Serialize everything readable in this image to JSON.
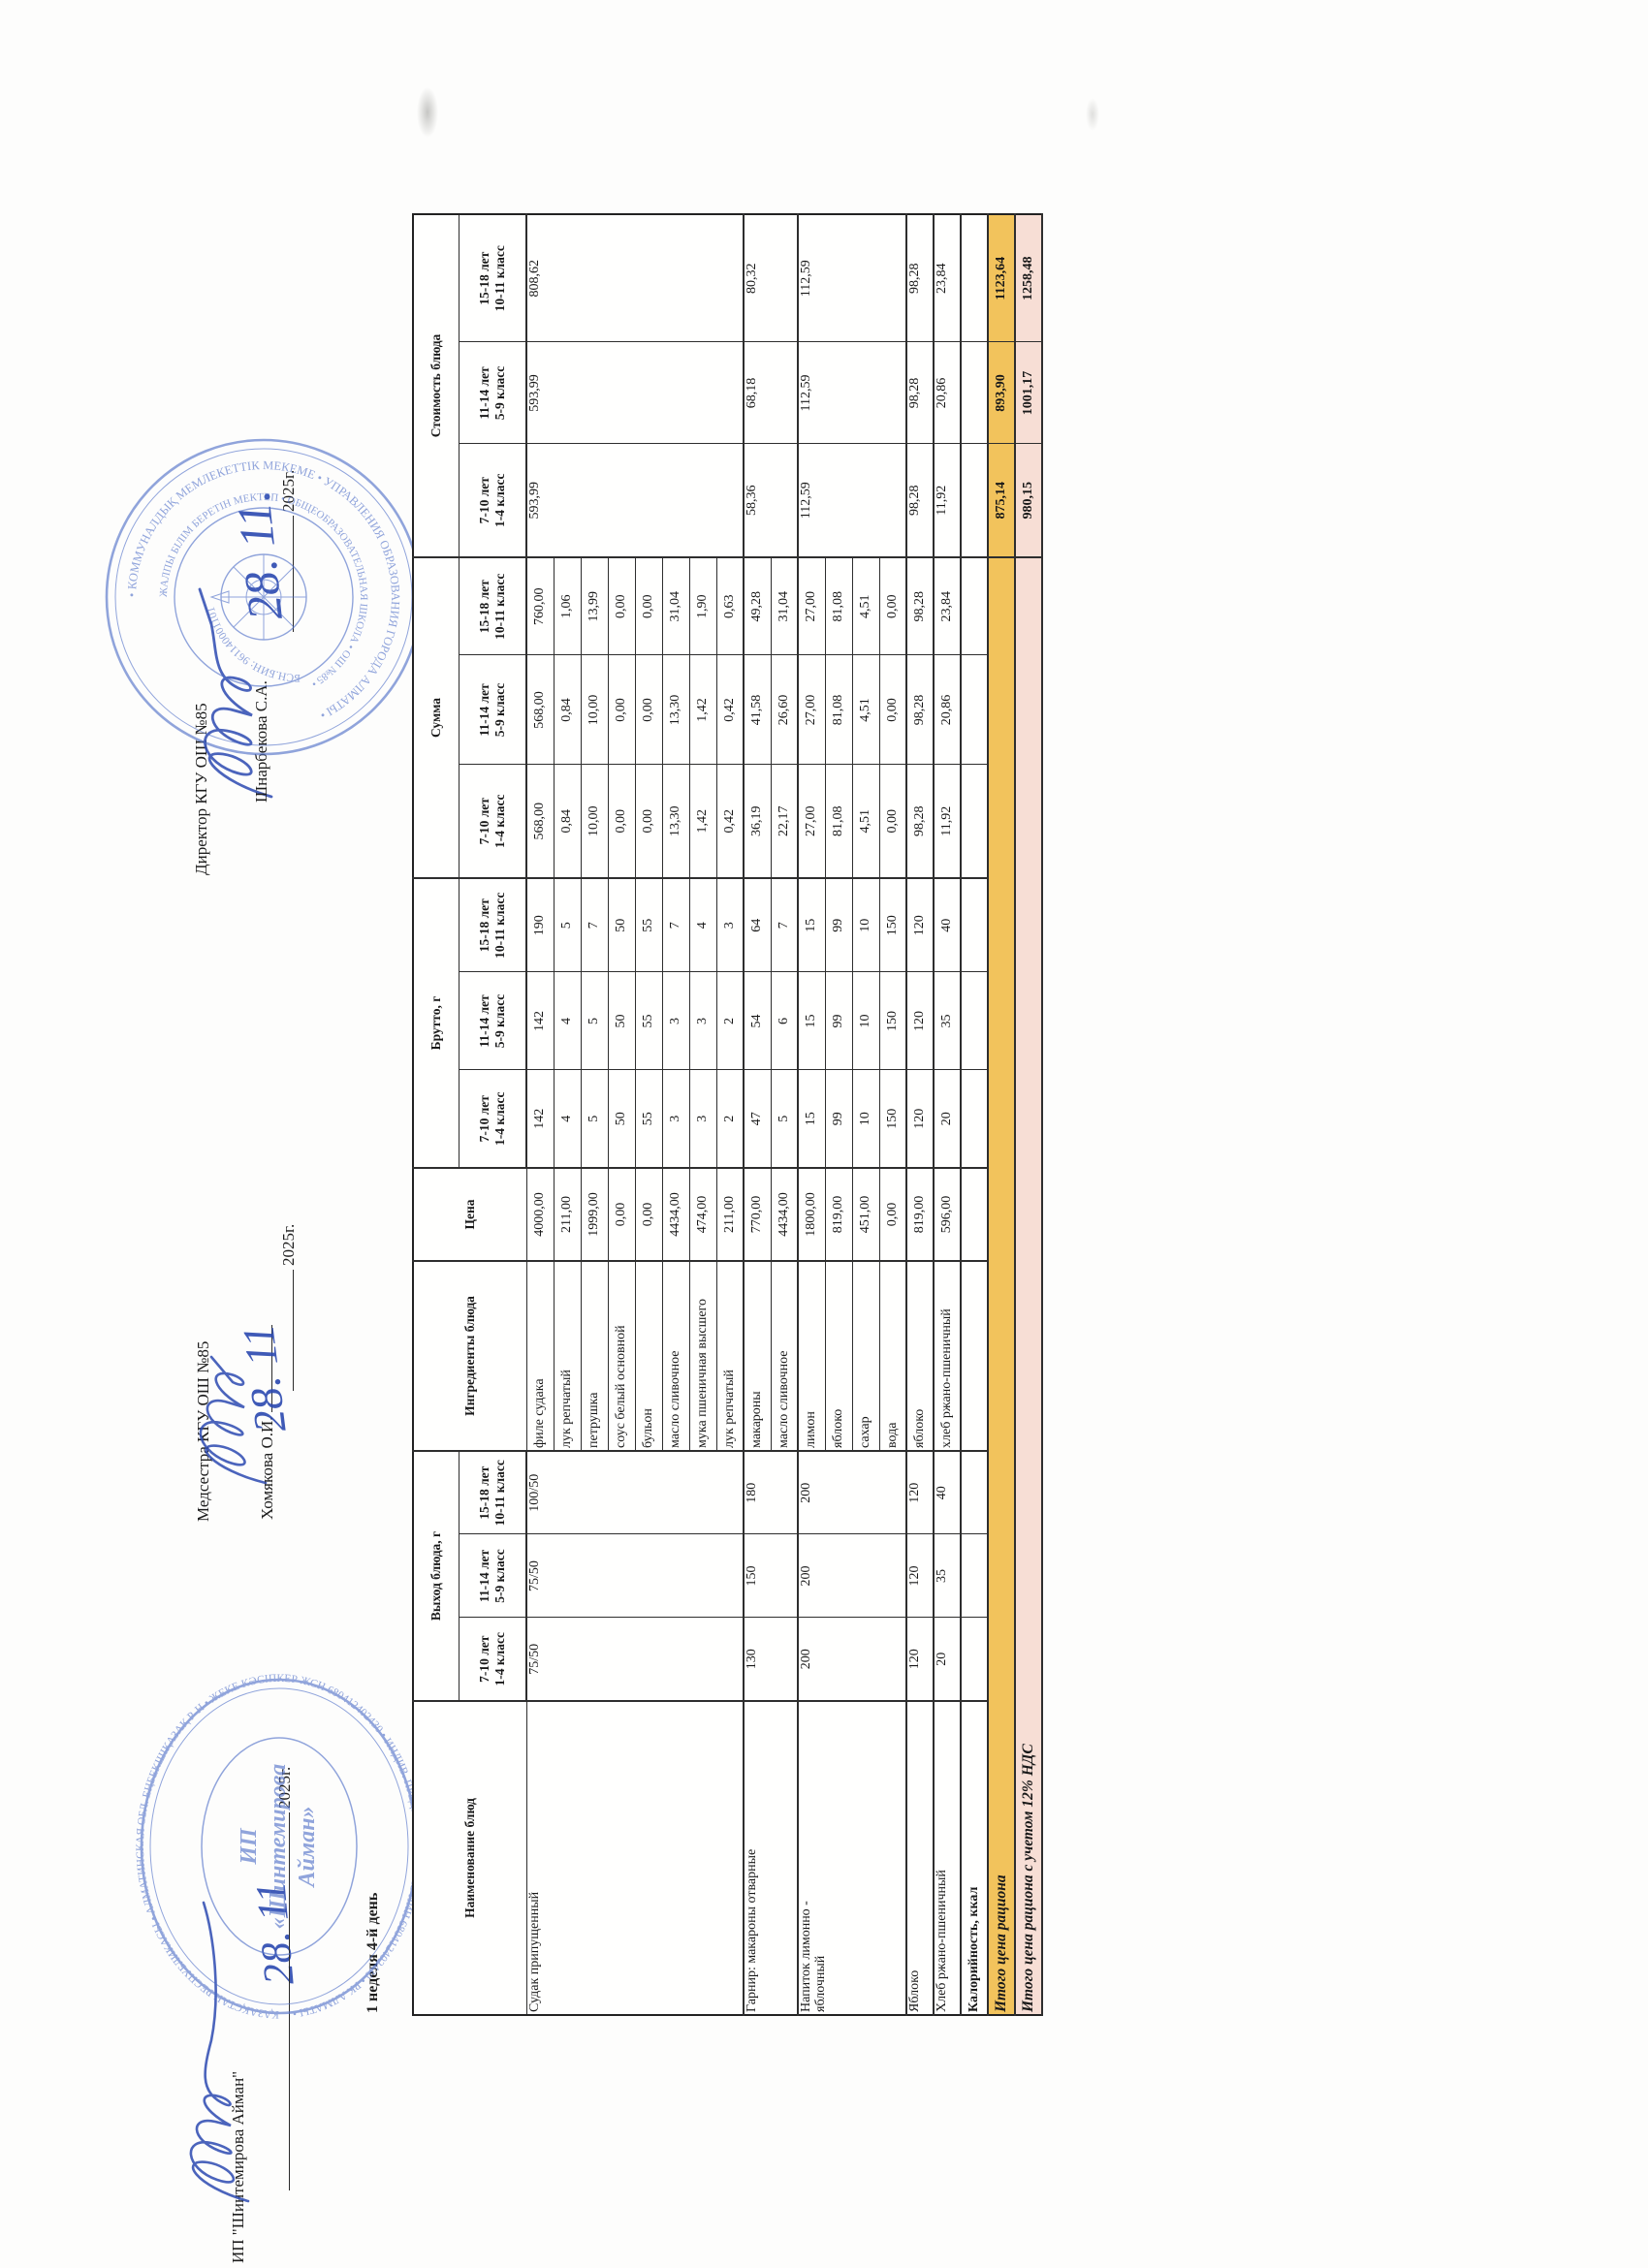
{
  "doc": {
    "left": {
      "org": "ИП \"Шинтемирова Айман\"",
      "year_line": "2025г.",
      "week_label": "1 неделя 4-й день",
      "handwritten_date": "28. 11"
    },
    "middle": {
      "role": "Медсестра КГУ ОШ №85",
      "name": "Хомякова О.И.",
      "year_line": "2025г.",
      "handwritten_date": "28. 11"
    },
    "right": {
      "role": "Директор КГУ ОШ №85",
      "name": "Шнарбекова С.А.",
      "year_line": "2025г.",
      "handwritten_date": "28. 11."
    }
  },
  "stamps": {
    "school": {
      "ring_text": "• КОММУНАЛДЫҚ МЕМЛЕКЕТТІК МЕКЕМЕ • УПРАВЛЕНИЯ ОБРАЗОВАНИЯ ГОРОДА АЛМАТЫ •",
      "ring_text2": "ЖАЛПЫ БІЛІМ БЕРЕТІН МЕКТЕП • ОБЩЕОБРАЗОВАТЕЛЬНАЯ ШКОЛА • ОШ №85 •",
      "bin_text": "БСН.БИН: 961140001101"
    },
    "ip": {
      "ring_text": "ҚАЗАҚСТАН РЕСПУБЛИКАСЫ • АЛМАТИНСКАЯ ОБЛ. ЕҢБЕКШІҚАЗАҚ Р-Н • ЖЕКЕ КӘСІПКЕР ЖСН 680412402430 • ИНДИВ. ПРЕДПРИНИМАТЕЛЬ ИИН 680412402430 • РК АЛМАТЫ •",
      "center_line1": "ИП",
      "center_line2": "«Шинтемирова",
      "center_line3": "Айман»"
    }
  },
  "table": {
    "headers": {
      "name": "Наименование блюд",
      "vyhod": "Выход блюда, г",
      "ingredients": "Ингредиенты блюда",
      "price": "Цена",
      "brutto": "Брутто, г",
      "summa": "Сумма",
      "cost": "Стоимость блюда"
    },
    "age_groups": [
      {
        "age": "7-10 лет",
        "grade": "1-4 класс"
      },
      {
        "age": "11-14 лет",
        "grade": "5-9 класс"
      },
      {
        "age": "15-18 лет",
        "grade": "10-11 класс"
      }
    ],
    "dishes": [
      {
        "name": "Судак припущенный",
        "vyhod": [
          "75/50",
          "75/50",
          "100/50"
        ],
        "cost": [
          "593,99",
          "593,99",
          "808,62"
        ],
        "ingredients": [
          {
            "name": "филе судака",
            "price": "4000,00",
            "brutto": [
              "142",
              "142",
              "190"
            ],
            "summa": [
              "568,00",
              "568,00",
              "760,00"
            ]
          },
          {
            "name": "лук репчатый",
            "price": "211,00",
            "brutto": [
              "4",
              "4",
              "5"
            ],
            "summa": [
              "0,84",
              "0,84",
              "1,06"
            ]
          },
          {
            "name": "петрушка",
            "price": "1999,00",
            "brutto": [
              "5",
              "5",
              "7"
            ],
            "summa": [
              "10,00",
              "10,00",
              "13,99"
            ]
          },
          {
            "name": "соус белый основной",
            "price": "0,00",
            "brutto": [
              "50",
              "50",
              "50"
            ],
            "summa": [
              "0,00",
              "0,00",
              "0,00"
            ]
          },
          {
            "name": "бульон",
            "price": "0,00",
            "brutto": [
              "55",
              "55",
              "55"
            ],
            "summa": [
              "0,00",
              "0,00",
              "0,00"
            ]
          },
          {
            "name": "масло сливочное",
            "price": "4434,00",
            "brutto": [
              "3",
              "3",
              "7"
            ],
            "summa": [
              "13,30",
              "13,30",
              "31,04"
            ]
          },
          {
            "name": "мука пшеничная высшего",
            "price": "474,00",
            "brutto": [
              "3",
              "3",
              "4"
            ],
            "summa": [
              "1,42",
              "1,42",
              "1,90"
            ]
          },
          {
            "name": "лук репчатый",
            "price": "211,00",
            "brutto": [
              "2",
              "2",
              "3"
            ],
            "summa": [
              "0,42",
              "0,42",
              "0,63"
            ]
          }
        ]
      },
      {
        "name": "Гарнир: макароны отварные",
        "vyhod": [
          "130",
          "150",
          "180"
        ],
        "cost": [
          "58,36",
          "68,18",
          "80,32"
        ],
        "ingredients": [
          {
            "name": "макароны",
            "price": "770,00",
            "brutto": [
              "47",
              "54",
              "64"
            ],
            "summa": [
              "36,19",
              "41,58",
              "49,28"
            ]
          },
          {
            "name": "масло сливочное",
            "price": "4434,00",
            "brutto": [
              "5",
              "6",
              "7"
            ],
            "summa": [
              "22,17",
              "26,60",
              "31,04"
            ]
          }
        ]
      },
      {
        "name": "Напиток лимонно -",
        "name2": "яблочный",
        "vyhod": [
          "200",
          "200",
          "200"
        ],
        "cost": [
          "112,59",
          "112,59",
          "112,59"
        ],
        "ingredients": [
          {
            "name": "лимон",
            "price": "1800,00",
            "brutto": [
              "15",
              "15",
              "15"
            ],
            "summa": [
              "27,00",
              "27,00",
              "27,00"
            ]
          },
          {
            "name": "яблоко",
            "price": "819,00",
            "brutto": [
              "99",
              "99",
              "99"
            ],
            "summa": [
              "81,08",
              "81,08",
              "81,08"
            ]
          },
          {
            "name": "сахар",
            "price": "451,00",
            "brutto": [
              "10",
              "10",
              "10"
            ],
            "summa": [
              "4,51",
              "4,51",
              "4,51"
            ]
          },
          {
            "name": "вода",
            "price": "0,00",
            "brutto": [
              "150",
              "150",
              "150"
            ],
            "summa": [
              "0,00",
              "0,00",
              "0,00"
            ]
          }
        ]
      },
      {
        "name": "Яблоко",
        "vyhod": [
          "120",
          "120",
          "120"
        ],
        "cost": [
          "98,28",
          "98,28",
          "98,28"
        ],
        "ingredients": [
          {
            "name": "яблоко",
            "price": "819,00",
            "brutto": [
              "120",
              "120",
              "120"
            ],
            "summa": [
              "98,28",
              "98,28",
              "98,28"
            ]
          }
        ]
      },
      {
        "name": "Хлеб ржано-пшеничный",
        "vyhod": [
          "20",
          "35",
          "40"
        ],
        "cost": [
          "11,92",
          "20,86",
          "23,84"
        ],
        "ingredients": [
          {
            "name": "хлеб ржано-пшеничный",
            "price": "596,00",
            "brutto": [
              "20",
              "35",
              "40"
            ],
            "summa": [
              "11,92",
              "20,86",
              "23,84"
            ]
          }
        ]
      }
    ],
    "calories_label": "Калорийность, ккал",
    "totals": [
      {
        "label": "Итого цена рациона",
        "values": [
          "875,14",
          "893,90",
          "1123,64"
        ],
        "bg": "#f2c35c"
      },
      {
        "label": "Итого цена рациона с учетом 12% НДС",
        "values": [
          "980,15",
          "1001,17",
          "1258,48"
        ],
        "bg": "#f7ded5"
      }
    ]
  },
  "colors": {
    "stamp_blue": "#4f6fc8",
    "ink_blue": "#2b49b0",
    "total_bg": "#f2c35c",
    "total_nds_bg": "#f7ded5"
  }
}
